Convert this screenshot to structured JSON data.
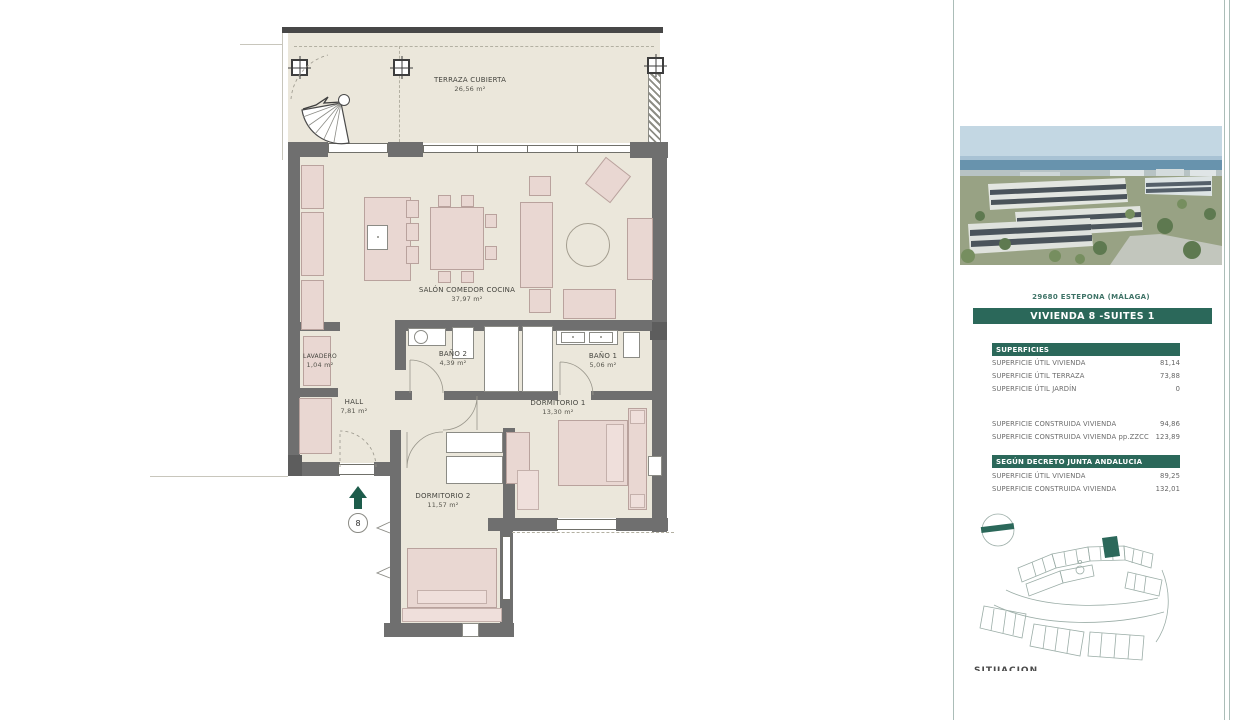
{
  "plan": {
    "terraza": {
      "name": "TERRAZA CUBIERTA",
      "area": "26,56 m²"
    },
    "salon": {
      "name": "SALÓN COMEDOR COCINA",
      "area": "37,97 m²"
    },
    "lavadero": {
      "name": "LAVADERO",
      "area": "1,04 m²"
    },
    "hall": {
      "name": "HALL",
      "area": "7,81 m²"
    },
    "bano2": {
      "name": "BAÑO 2",
      "area": "4,39 m²"
    },
    "bano1": {
      "name": "BAÑO 1",
      "area": "5,06 m²"
    },
    "dorm1": {
      "name": "DORMITORIO 1",
      "area": "13,30 m²"
    },
    "dorm2": {
      "name": "DORMITORIO 2",
      "area": "11,57 m²"
    },
    "entrance_number": "8"
  },
  "sidebar": {
    "address": "29680 ESTEPONA (MÁLAGA)",
    "banner": "VIVIENDA 8 -SUITES 1",
    "superficies": {
      "title": "SUPERFICIES",
      "rows": [
        {
          "label": "SUPERFICIE ÚTIL VIVIENDA",
          "value": "81,14"
        },
        {
          "label": "SUPERFICIE ÚTIL TERRAZA",
          "value": "73,88"
        },
        {
          "label": "SUPERFICIE ÚTIL JARDÍN",
          "value": "0"
        }
      ],
      "rows2": [
        {
          "label": "SUPERFICIE CONSTRUIDA VIVIENDA",
          "value": "94,86"
        },
        {
          "label": "SUPERFICIE CONSTRUIDA VIVIENDA pp.ZZCC",
          "value": "123,89"
        }
      ]
    },
    "decreto": {
      "title": "SEGÚN DECRETO JUNTA ANDALUCIA",
      "rows": [
        {
          "label": "SUPERFICIE ÚTIL VIVIENDA",
          "value": "89,25"
        },
        {
          "label": "SUPERFICIE CONSTRUIDA VIVIENDA",
          "value": "132,01"
        }
      ]
    },
    "footer": "SITUACIÓN"
  },
  "colors": {
    "accent_green": "#2b685a",
    "wall_gray": "#6f6f6f",
    "floor_beige": "#ebe7db"
  }
}
